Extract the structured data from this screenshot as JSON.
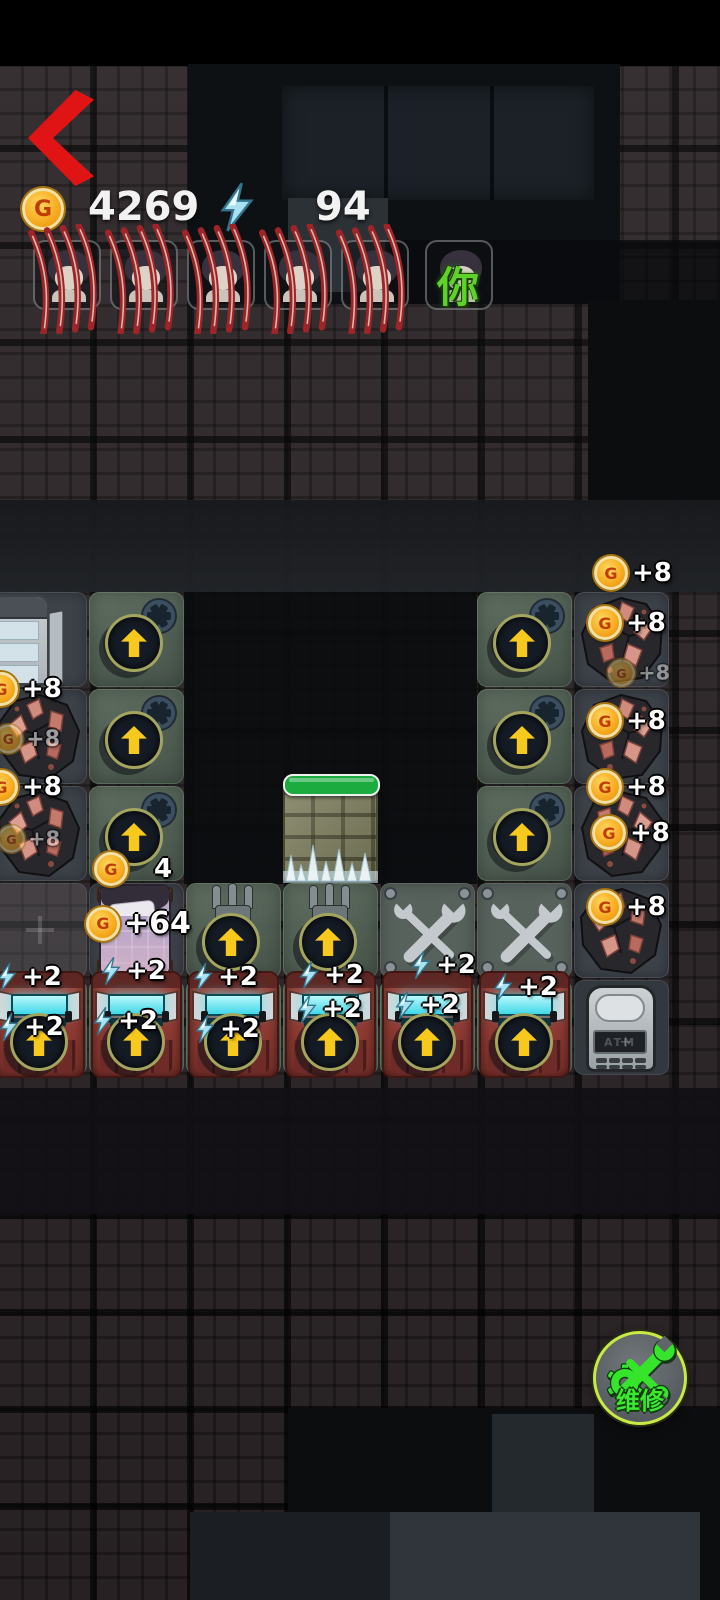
{
  "hud": {
    "coin_symbol": "G",
    "coin_value": "4269",
    "energy_value": "94"
  },
  "party": {
    "slots": [
      {
        "state": "ko"
      },
      {
        "state": "ko"
      },
      {
        "state": "ko"
      },
      {
        "state": "ko"
      },
      {
        "state": "ko"
      },
      {
        "state": "active",
        "overlay": "你"
      }
    ]
  },
  "board": {
    "atm_screen_text": "ATM",
    "tiles": [
      {
        "type": "fridge",
        "col": 1,
        "row": 1
      },
      {
        "type": "upgrade",
        "col": 2,
        "row": 1
      },
      {
        "type": "upgrade",
        "col": 6,
        "row": 1
      },
      {
        "type": "ore",
        "col": 7,
        "row": 1
      },
      {
        "type": "ore",
        "col": 1,
        "row": 2
      },
      {
        "type": "upgrade",
        "col": 2,
        "row": 2
      },
      {
        "type": "upgrade",
        "col": 6,
        "row": 2
      },
      {
        "type": "ore",
        "col": 7,
        "row": 2
      },
      {
        "type": "ore",
        "col": 1,
        "row": 3
      },
      {
        "type": "upgrade",
        "col": 2,
        "row": 3
      },
      {
        "type": "wall",
        "col": 4,
        "row": 3
      },
      {
        "type": "upgrade",
        "col": 6,
        "row": 3
      },
      {
        "type": "ore",
        "col": 7,
        "row": 3
      },
      {
        "type": "empty",
        "col": 1,
        "row": 4
      },
      {
        "type": "bed",
        "col": 2,
        "row": 4
      },
      {
        "type": "fork",
        "col": 3,
        "row": 4
      },
      {
        "type": "fork",
        "col": 4,
        "row": 4
      },
      {
        "type": "wrench",
        "col": 5,
        "row": 4
      },
      {
        "type": "wrench",
        "col": 6,
        "row": 4
      },
      {
        "type": "ore",
        "col": 7,
        "row": 4
      },
      {
        "type": "machine",
        "col": 1,
        "row": 5
      },
      {
        "type": "machine",
        "col": 2,
        "row": 5
      },
      {
        "type": "machine",
        "col": 3,
        "row": 5
      },
      {
        "type": "machine",
        "col": 4,
        "row": 5
      },
      {
        "type": "machine",
        "col": 5,
        "row": 5
      },
      {
        "type": "machine",
        "col": 6,
        "row": 5
      },
      {
        "type": "atm",
        "col": 7,
        "row": 5
      }
    ]
  },
  "coin_labels": [
    {
      "x": -16,
      "y": 672,
      "text": "+8"
    },
    {
      "x": -12,
      "y": 722,
      "text": "+8",
      "opacity": 0.55,
      "scale": 0.85
    },
    {
      "x": -16,
      "y": 770,
      "text": "+8"
    },
    {
      "x": -10,
      "y": 822,
      "text": "+8",
      "opacity": 0.5,
      "scale": 0.8
    },
    {
      "x": 94,
      "y": 852,
      "text": "4",
      "dx": 22
    },
    {
      "x": 86,
      "y": 906,
      "text": "+64",
      "big": true
    },
    {
      "x": 594,
      "y": 556,
      "text": "+8"
    },
    {
      "x": 588,
      "y": 606,
      "text": "+8"
    },
    {
      "x": 600,
      "y": 656,
      "text": "+8",
      "opacity": 0.45,
      "scale": 0.8
    },
    {
      "x": 588,
      "y": 704,
      "text": "+8"
    },
    {
      "x": 588,
      "y": 770,
      "text": "+8"
    },
    {
      "x": 592,
      "y": 816,
      "text": "+8"
    },
    {
      "x": 588,
      "y": 890,
      "text": "+8"
    }
  ],
  "energy_labels": [
    {
      "x": -4,
      "y": 962,
      "text": "+2"
    },
    {
      "x": 100,
      "y": 956,
      "text": "+2"
    },
    {
      "x": 192,
      "y": 962,
      "text": "+2"
    },
    {
      "x": 298,
      "y": 960,
      "text": "+2"
    },
    {
      "x": 410,
      "y": 950,
      "text": "+2"
    },
    {
      "x": 492,
      "y": 972,
      "text": "+2"
    },
    {
      "x": -2,
      "y": 1012,
      "text": "+2"
    },
    {
      "x": 92,
      "y": 1006,
      "text": "+2"
    },
    {
      "x": 194,
      "y": 1014,
      "text": "+2"
    },
    {
      "x": 296,
      "y": 994,
      "text": "+2"
    },
    {
      "x": 394,
      "y": 990,
      "text": "+2"
    }
  ],
  "repair_button": {
    "label": "维修"
  },
  "colors": {
    "coin_gold": "#f5b11c",
    "energy_cyan": "#8fd7ea",
    "hp_green": "#1cab3f",
    "arrow_yellow": "#f6c91c",
    "repair_green": "#35e42b",
    "claw_red": "#9e2427",
    "machine_red": "#8d3a33",
    "tile_green": "#55645a"
  }
}
